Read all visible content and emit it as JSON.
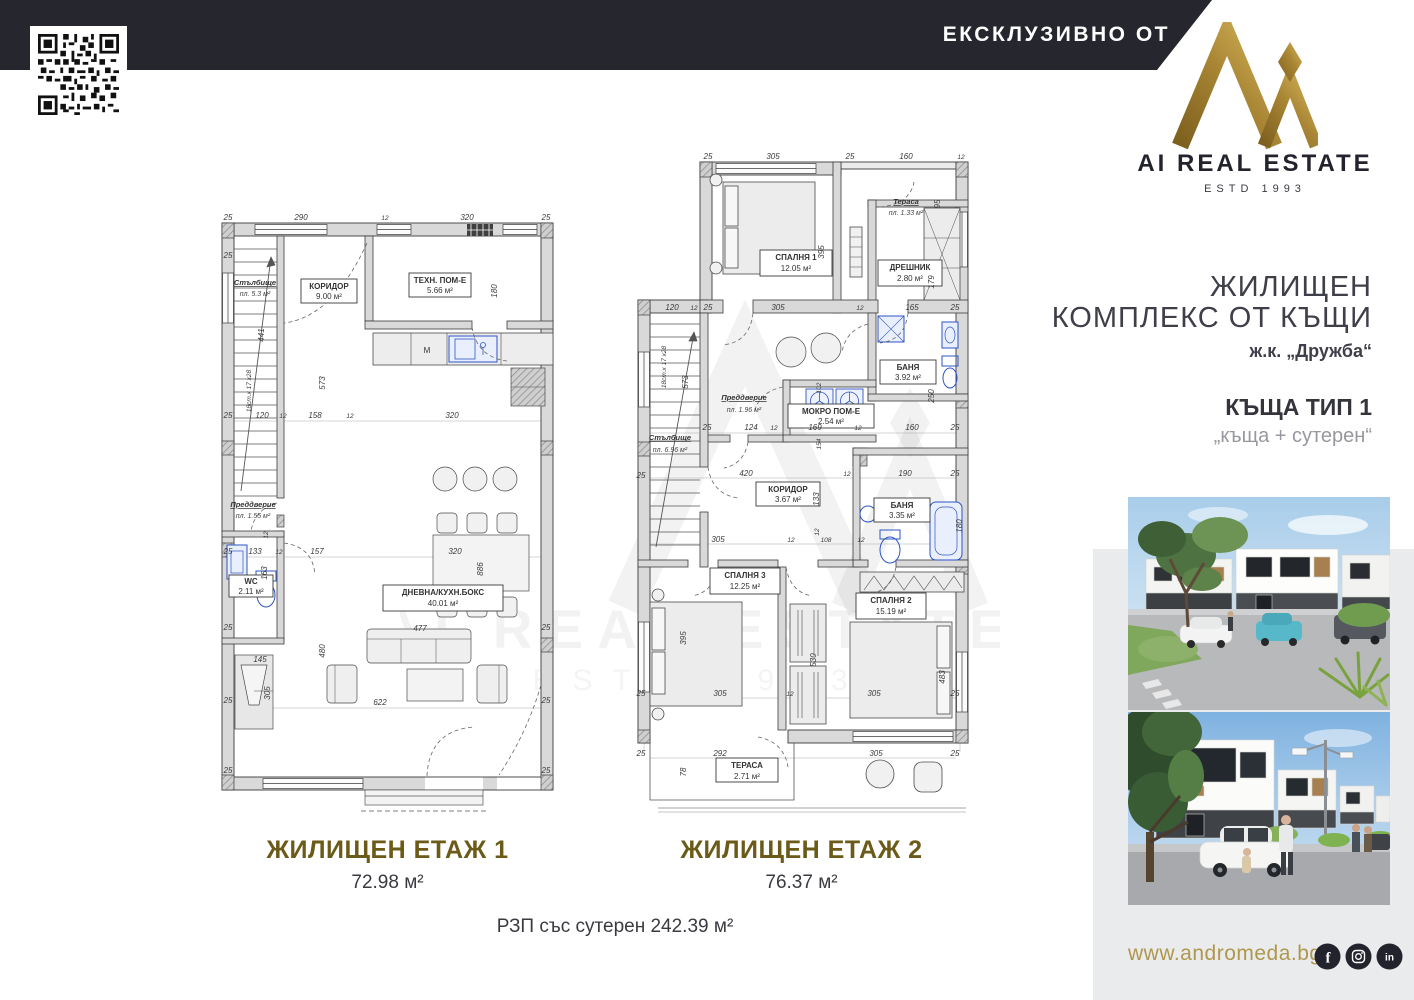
{
  "header": {
    "exclusive_label": "ЕКСКЛУЗИВНО ОТ"
  },
  "brand": {
    "name": "AI REAL ESTATE",
    "estd": "ESTD 1993"
  },
  "project": {
    "title_line1": "ЖИЛИЩЕН",
    "title_line2": "КОМПЛЕКС ОТ КЪЩИ",
    "location": "ж.к. „Дружба“",
    "house_type": "КЪЩА ТИП 1",
    "house_subtype": "„къща + сутерен“"
  },
  "footer": {
    "website": "www.andromeda.bg",
    "socials": [
      "facebook",
      "instagram",
      "linkedin"
    ],
    "total_area": "РЗП със сутерен 242.39 м²"
  },
  "watermark": {
    "line1": "AI REAL ESTATE",
    "line2": "ESTD 1993"
  },
  "floor1": {
    "title": "ЖИЛИЩЕН ЕТАЖ 1",
    "area": "72.98 м²",
    "kitchen_marker": "М",
    "rooms": {
      "stairs": {
        "name": "Стълбище",
        "area": "пл. 5.3 м²"
      },
      "corridor": {
        "name": "КОРИДОР",
        "area": "9.00 м²"
      },
      "tech": {
        "name": "ТЕХН. ПОМ-Е",
        "area": "5.66 м²"
      },
      "entry": {
        "name": "Преддверие",
        "area": "пл. 1.55 м²"
      },
      "wc": {
        "name": "WC",
        "area": "2.11 м²"
      },
      "living": {
        "name": "ДНЕВНА/КУХН.БОКС",
        "area": "40.01 м²"
      }
    },
    "dims": [
      {
        "v": "25",
        "x": 13,
        "y": 7
      },
      {
        "v": "290",
        "x": 86,
        "y": 7
      },
      {
        "v": "12",
        "x": 170,
        "y": 7,
        "s": 1
      },
      {
        "v": "320",
        "x": 252,
        "y": 7
      },
      {
        "v": "25",
        "x": 331,
        "y": 7
      },
      {
        "v": "25",
        "x": 13,
        "y": 45
      },
      {
        "v": "441",
        "x": 49,
        "y": 122,
        "r": 1
      },
      {
        "v": "573",
        "x": 110,
        "y": 170,
        "r": 1
      },
      {
        "v": "18ст.х 17 х28",
        "x": 36,
        "y": 178,
        "r": 1,
        "s": 1
      },
      {
        "v": "180",
        "x": 282,
        "y": 78,
        "r": 1
      },
      {
        "v": "25",
        "x": 13,
        "y": 205
      },
      {
        "v": "120",
        "x": 47,
        "y": 205
      },
      {
        "v": "12",
        "x": 68,
        "y": 205,
        "s": 1
      },
      {
        "v": "158",
        "x": 100,
        "y": 205
      },
      {
        "v": "12",
        "x": 135,
        "y": 205,
        "s": 1
      },
      {
        "v": "320",
        "x": 237,
        "y": 205
      },
      {
        "v": "12",
        "x": 53,
        "y": 322,
        "r": 1,
        "s": 1
      },
      {
        "v": "25",
        "x": 13,
        "y": 341
      },
      {
        "v": "133",
        "x": 40,
        "y": 341
      },
      {
        "v": "12",
        "x": 64,
        "y": 341,
        "s": 1
      },
      {
        "v": "157",
        "x": 102,
        "y": 341
      },
      {
        "v": "320",
        "x": 240,
        "y": 341
      },
      {
        "v": "886",
        "x": 268,
        "y": 356,
        "r": 1
      },
      {
        "v": "163",
        "x": 52,
        "y": 360,
        "r": 1
      },
      {
        "v": "25",
        "x": 13,
        "y": 417
      },
      {
        "v": "25",
        "x": 331,
        "y": 417
      },
      {
        "v": "145",
        "x": 45,
        "y": 449
      },
      {
        "v": "480",
        "x": 110,
        "y": 438,
        "r": 1
      },
      {
        "v": "305",
        "x": 55,
        "y": 480,
        "r": 1
      },
      {
        "v": "477",
        "x": 205,
        "y": 418
      },
      {
        "v": "622",
        "x": 165,
        "y": 492
      },
      {
        "v": "25",
        "x": 13,
        "y": 490
      },
      {
        "v": "25",
        "x": 331,
        "y": 490
      },
      {
        "v": "25",
        "x": 13,
        "y": 560
      },
      {
        "v": "25",
        "x": 331,
        "y": 560
      }
    ]
  },
  "floor2": {
    "title": "ЖИЛИЩЕН ЕТАЖ 2",
    "area": "76.37 м²",
    "rooms": {
      "bedroom1": {
        "name": "СПАЛНЯ 1",
        "area": "12.05 м²"
      },
      "terrace_top": {
        "name": "Тераса",
        "area": "пл. 1.33 м²"
      },
      "closet": {
        "name": "ДРЕШНИК",
        "area": "2.80 м²"
      },
      "bath1": {
        "name": "БАНЯ",
        "area": "3.92 м²"
      },
      "wet": {
        "name": "МОКРО ПОМ-Е",
        "area": "2.54 м²"
      },
      "entry": {
        "name": "Преддверие",
        "area": "пл. 1.96 м²"
      },
      "stairs": {
        "name": "Стълбище",
        "area": "пл. 6.96 м²"
      },
      "corridor": {
        "name": "КОРИДОР",
        "area": "3.67 м²"
      },
      "bath2": {
        "name": "БАНЯ",
        "area": "3.35 м²"
      },
      "bedroom3": {
        "name": "СПАЛНЯ 3",
        "area": "12.25 м²"
      },
      "bedroom2": {
        "name": "СПАЛНЯ 2",
        "area": "15.19 м²"
      },
      "terrace": {
        "name": "ТЕРАСА",
        "area": "2.71 м²"
      }
    },
    "dims": [
      {
        "v": "25",
        "x": 80,
        "y": 7
      },
      {
        "v": "305",
        "x": 145,
        "y": 7
      },
      {
        "v": "25",
        "x": 222,
        "y": 7
      },
      {
        "v": "160",
        "x": 278,
        "y": 7
      },
      {
        "v": "12",
        "x": 333,
        "y": 7,
        "s": 1
      },
      {
        "v": "95",
        "x": 312,
        "y": 52,
        "r": 1
      },
      {
        "v": "179",
        "x": 306,
        "y": 130,
        "r": 1
      },
      {
        "v": "395",
        "x": 196,
        "y": 100,
        "r": 1
      },
      {
        "v": "120",
        "x": 44,
        "y": 158
      },
      {
        "v": "12",
        "x": 66,
        "y": 158,
        "s": 1
      },
      {
        "v": "25",
        "x": 80,
        "y": 158
      },
      {
        "v": "305",
        "x": 150,
        "y": 158
      },
      {
        "v": "12",
        "x": 232,
        "y": 158,
        "s": 1
      },
      {
        "v": "165",
        "x": 284,
        "y": 158
      },
      {
        "v": "25",
        "x": 327,
        "y": 158
      },
      {
        "v": "18ст.х 17 х28",
        "x": 38,
        "y": 215,
        "r": 1,
        "s": 1
      },
      {
        "v": "573",
        "x": 60,
        "y": 230,
        "r": 1
      },
      {
        "v": "25",
        "x": 79,
        "y": 278
      },
      {
        "v": "124",
        "x": 123,
        "y": 278
      },
      {
        "v": "12",
        "x": 146,
        "y": 278,
        "s": 1
      },
      {
        "v": "169",
        "x": 187,
        "y": 278
      },
      {
        "v": "12",
        "x": 230,
        "y": 278,
        "s": 1
      },
      {
        "v": "160",
        "x": 284,
        "y": 278
      },
      {
        "v": "25",
        "x": 327,
        "y": 278
      },
      {
        "v": "102",
        "x": 193,
        "y": 236,
        "r": 1,
        "s": 1
      },
      {
        "v": "154",
        "x": 193,
        "y": 292,
        "r": 1,
        "s": 1
      },
      {
        "v": "250",
        "x": 306,
        "y": 244,
        "r": 1
      },
      {
        "v": "25",
        "x": 13,
        "y": 326
      },
      {
        "v": "420",
        "x": 118,
        "y": 324
      },
      {
        "v": "12",
        "x": 219,
        "y": 324,
        "s": 1
      },
      {
        "v": "190",
        "x": 277,
        "y": 324
      },
      {
        "v": "25",
        "x": 327,
        "y": 324
      },
      {
        "v": "133",
        "x": 191,
        "y": 347,
        "r": 1
      },
      {
        "v": "12",
        "x": 191,
        "y": 380,
        "r": 1,
        "s": 1
      },
      {
        "v": "180",
        "x": 334,
        "y": 374,
        "r": 1
      },
      {
        "v": "305",
        "x": 90,
        "y": 390
      },
      {
        "v": "12",
        "x": 163,
        "y": 390,
        "s": 1
      },
      {
        "v": "108",
        "x": 198,
        "y": 390,
        "s": 1
      },
      {
        "v": "12",
        "x": 233,
        "y": 390,
        "s": 1
      },
      {
        "v": "395",
        "x": 58,
        "y": 486,
        "r": 1
      },
      {
        "v": "530",
        "x": 188,
        "y": 508,
        "r": 1
      },
      {
        "v": "483",
        "x": 317,
        "y": 525,
        "r": 1
      },
      {
        "v": "25",
        "x": 13,
        "y": 544
      },
      {
        "v": "305",
        "x": 92,
        "y": 544
      },
      {
        "v": "12",
        "x": 162,
        "y": 544,
        "s": 1
      },
      {
        "v": "305",
        "x": 246,
        "y": 544
      },
      {
        "v": "25",
        "x": 327,
        "y": 544
      },
      {
        "v": "25",
        "x": 13,
        "y": 604
      },
      {
        "v": "292",
        "x": 92,
        "y": 604
      },
      {
        "v": "305",
        "x": 248,
        "y": 604
      },
      {
        "v": "25",
        "x": 327,
        "y": 604
      },
      {
        "v": "78",
        "x": 58,
        "y": 620,
        "r": 1
      }
    ]
  }
}
